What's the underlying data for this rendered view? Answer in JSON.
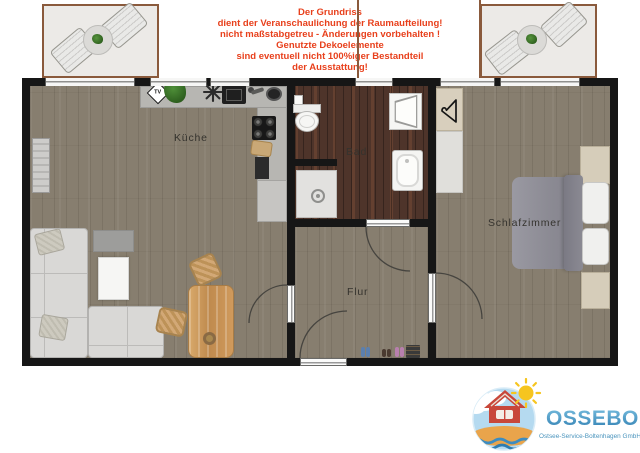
{
  "disclaimer": {
    "lines": [
      "Der Grundriss",
      "dient der Veranschaulichung der Raumaufteilung!",
      "nicht maßstabgetreu - Änderungen vorbehalten !",
      "Genutzte Dekoelemente",
      "sind eventuell nicht 100%iger Bestandteil",
      "der Ausstattung!"
    ]
  },
  "plan": {
    "rooms": {
      "kitchen": "Küche",
      "bath": "Bad",
      "hall": "Flur",
      "bedroom": "Schlafzimmer"
    },
    "tv_icon_label": "TV"
  },
  "logo": {
    "company": "OSSEBO",
    "subtitle": "Ostsee-Service-Boltenhagen GmbH"
  },
  "colors": {
    "wall": "#161616",
    "living-floor": "#877e6f",
    "bath-floor": "#4e342a",
    "balcony-floor": "#eceae7",
    "balcony-frame": "#8a5a3c",
    "counter": "#b7b6b2",
    "counter-low": "#c6c5c2",
    "sofa": "#d9d8d6",
    "disclaimer": "#e8401c",
    "label": "#35332e",
    "logo-text": "#3f93c4",
    "logo-sub": "#4a94bd",
    "logo-grad-top": "#79bedf",
    "logo-grad-bottom": "#2d7cb0",
    "door-arc": "#46443f"
  }
}
